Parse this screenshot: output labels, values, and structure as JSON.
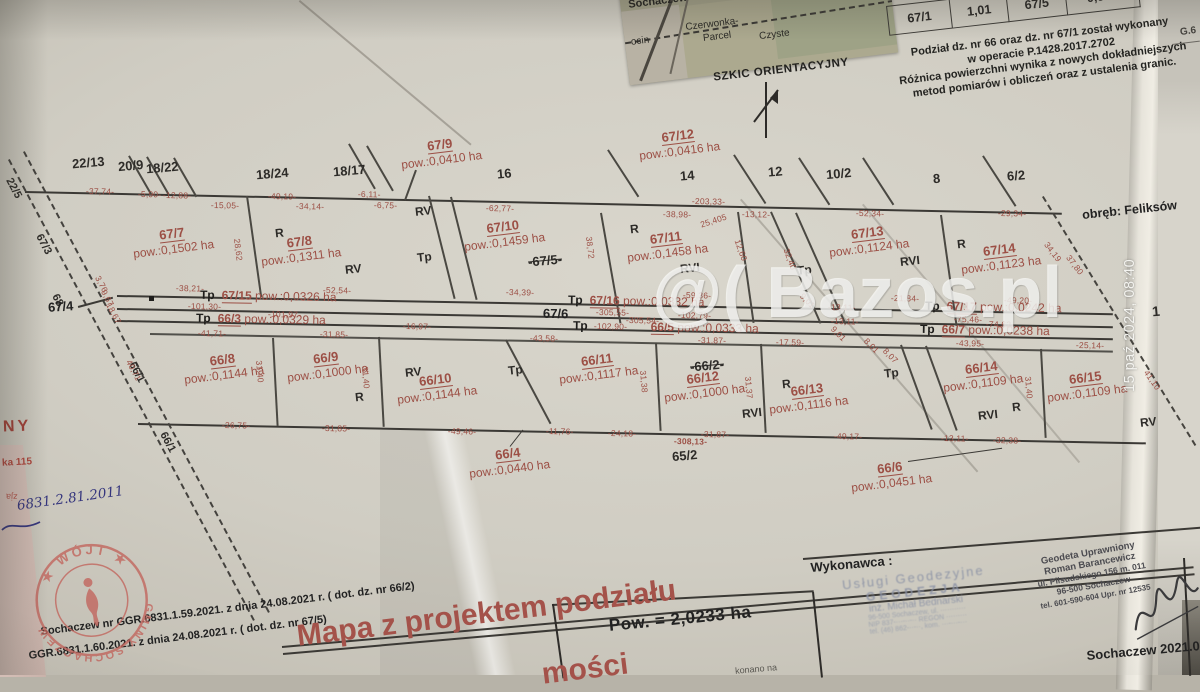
{
  "photo": {
    "timestamp": "15 paź 2024, 08:40",
    "watermark": "@( Bazos.pl",
    "corner_fragment": "G.6"
  },
  "inset": {
    "caption": "SZKIC ORIENTACYJNY",
    "places": {
      "p1": "Sochaczew",
      "p2": "Wieś",
      "p3": "Kożuszki",
      "p4": "ocin",
      "p5": "Czerwonka-",
      "p6": "Parcel",
      "p7": "Czyste"
    }
  },
  "note": {
    "cells": [
      "67/1",
      "1,01",
      "67/5",
      "0,970"
    ],
    "lines": [
      "Podział dz. nr 66 oraz dz. nr 67/1 został wykonany",
      "w operacie P.1428.2017.2702",
      "Różnica powierzchni wynika z nowych dokładniejszych",
      "metod pomiarów i obliczeń oraz z ustalenia granic."
    ]
  },
  "map": {
    "obreb": "obręb: Feliksów",
    "neighbors": [
      "22/13",
      "20/9",
      "18/22",
      "18/24",
      "18/17",
      "16",
      "14",
      "12",
      "10/2",
      "8",
      "6/2"
    ],
    "right_parcel": "1",
    "bottom_parcel": "65/2",
    "crossed": [
      "-67/5-",
      "-66/2-"
    ],
    "roads": {
      "r1": "22/5",
      "r2": "67/3",
      "r3": "68",
      "r4": "66/1",
      "r5": "67/4",
      "r6": "67/6"
    },
    "soil": [
      "R",
      "RV",
      "Tp",
      "RVI"
    ],
    "parcels": {
      "p67_7": {
        "id": "67/7",
        "area": "pow.:0,1502 ha"
      },
      "p67_8": {
        "id": "67/8",
        "area": "pow.:0,1311 ha"
      },
      "p67_9": {
        "id": "67/9",
        "area": "pow.:0,0410 ha"
      },
      "p67_10": {
        "id": "67/10",
        "area": "pow.:0,1459 ha"
      },
      "p67_11": {
        "id": "67/11",
        "area": "pow.:0,1458 ha"
      },
      "p67_12": {
        "id": "67/12",
        "area": "pow.:0,0416 ha"
      },
      "p67_13": {
        "id": "67/13",
        "area": "pow.:0,1124 ha"
      },
      "p67_14": {
        "id": "67/14",
        "area": "pow.:0,1123 ha"
      },
      "p67_15": {
        "id": "67/15",
        "area": "pow.:0,0326 ha"
      },
      "p67_16": {
        "id": "67/16",
        "area": "pow.:0,0332 ha"
      },
      "p67_17": {
        "id": "67/17",
        "area": "pow.:0,0242 ha"
      },
      "p66_3": {
        "id": "66/3",
        "area": "pow.:0,0329 ha"
      },
      "p66_5": {
        "id": "66/5",
        "area": "pow.:0,0333 ha"
      },
      "p66_7": {
        "id": "66/7",
        "area": "pow.:0,0238 ha"
      },
      "p66_8": {
        "id": "66/8",
        "area": "pow.:0,1144 ha"
      },
      "p66_9": {
        "id": "66/9",
        "area": "pow.:0,1000 ha"
      },
      "p66_10": {
        "id": "66/10",
        "area": "pow.:0,1144 ha"
      },
      "p66_11": {
        "id": "66/11",
        "area": "pow.:0,1117 ha"
      },
      "p66_12": {
        "id": "66/12",
        "area": "pow.:0,1000 ha"
      },
      "p66_13": {
        "id": "66/13",
        "area": "pow.:0,1116 ha"
      },
      "p66_14": {
        "id": "66/14",
        "area": "pow.:0,1109 ha"
      },
      "p66_15": {
        "id": "66/15",
        "area": "pow.:0,1109 ha"
      },
      "p66_4": {
        "id": "66/4",
        "area": "pow.:0,0440 ha"
      },
      "p66_6": {
        "id": "66/6",
        "area": "pow.:0,0451 ha"
      }
    },
    "measurements": [
      "-37,74-",
      "-5,90-",
      "-12,88-",
      "-15,05-",
      "-49,19-",
      "-34,14-",
      "-6,11-",
      "-6,75-",
      "-62,77-",
      "-203,33-",
      "-38,98-",
      "-13,12-",
      "-52,34-",
      "-29,34-",
      "25,405",
      "-38,21-",
      "-52,54-",
      "-101,30-",
      "-101,97-",
      "-41,71-",
      "-31,85-",
      "-16,97-",
      "-34,39-",
      "-59,36-",
      "-305,55-",
      "-305,54-",
      "-102,79-",
      "-102,90-",
      "-43,58-",
      "-31,87-",
      "-17,59-",
      "-13,11-",
      "-21,84-",
      "-49,20-",
      "-75,46-",
      "-74,62-",
      "-43,95-",
      "-25,14-",
      "-26,75-",
      "-49,46-",
      "-11,76-",
      "-24,18-",
      "-308,13-",
      "-49,17-",
      "-32,38-",
      "28,62",
      "38,72",
      "31,40",
      "31,38",
      "31,37",
      "34,19",
      "37,80",
      "41,10",
      "40,71",
      "12,60",
      "32,40",
      "9,01",
      "8,01",
      "8,07",
      "3,76",
      "9,67",
      "18,67"
    ]
  },
  "titleblock": {
    "legal1": "Sochaczew nr GGR.6831.1.59.2021. z dnia 24.08.2021 r. ( dot. dz. nr 66/2)",
    "legal2": "GGR.6831.1.60.2021. z dnia 24.08.2021 r. ( dot. dz. nr 67/5)",
    "title": "Mapa z projektem podziału",
    "title_fragment": "mości",
    "total_area": "Pow. = 2,0233 ha",
    "faint": "konano na",
    "wykonawca_label": "Wykonawca :",
    "stamp_firm": {
      "l1": "Usługi Geodezyjne",
      "l2": "GEODEZJA",
      "l3": "inż. Michał Bednarski",
      "l4": "96-500 Sochaczew, ul. ···········",
      "l5": "NIP 837-···-··-··   REGON ·········",
      "l6": "tel. (46) 862-··-··, kom. ···-···-···"
    },
    "stamp_surveyor": {
      "l1": "Geodeta Uprawniony",
      "l2": "Roman Barancewicz",
      "l3": "ul. Piłsudskiego 156 m. 011",
      "l4": "96-500 Sochaczew",
      "l5": "tel. 601-590-604  Upr. nr 12535"
    },
    "place_date": "Sochaczew 2021.09",
    "stamp_round": {
      "top": "★ WÓJT ★",
      "bottom": "GMINY SOCHACZEW"
    },
    "handwritten": "6831.2.81.2011",
    "red_fragments": {
      "f1": "NY",
      "f2": "ka 115",
      "f3": "zja"
    }
  }
}
